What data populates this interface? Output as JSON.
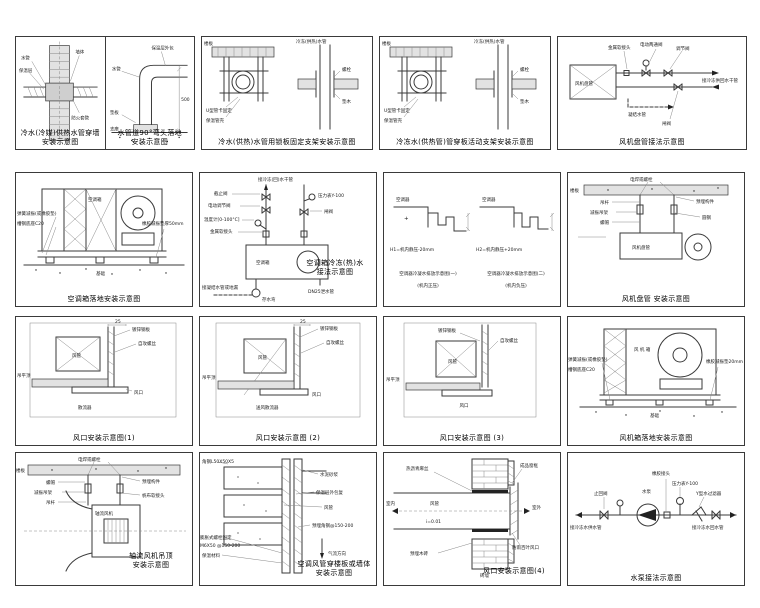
{
  "page": {
    "background": "#ffffff"
  },
  "panels": {
    "r1p1": {
      "caption1": "冷水(冷媒)供热水管穿墙",
      "caption2": "安装示意图",
      "labels": {
        "pipe": "水管",
        "insulation": "保温层",
        "wall": "墙体",
        "sleeve": "防火套管"
      }
    },
    "r1p2": {
      "caption1": "水管道90°弯头落地",
      "caption2": "安装示意图",
      "labels": {
        "insulation": "保温层外包",
        "pipe": "水管",
        "pad": "垫板",
        "support": "支座",
        "dim": "500"
      }
    },
    "r1p3": {
      "caption1": "冷水(供热)水管用锁板固定支架安装示意图",
      "labels": {
        "slab": "楼板",
        "clamp": "U型管卡固定",
        "shell": "保温管壳",
        "pipe": "冷冻(供热)水管",
        "bolt": "螺栓",
        "wood": "垫木"
      }
    },
    "r1p4": {
      "caption1": "冷冻水(供热管)管穿板活动支架安装示意图",
      "labels": {
        "slab": "楼板",
        "clamp": "U型管卡固定",
        "shell": "保温管壳",
        "pipe": "冷冻(供热)水管",
        "bolt": "螺栓",
        "wood": "垫木"
      }
    },
    "r1p5": {
      "caption1": "风机盘管接法示意图",
      "labels": {
        "joint": "金属软接头",
        "valve": "电动两通阀",
        "regulate": "调节阀",
        "unit": "风机盘管",
        "drain": "凝结水管",
        "gate": "闸阀",
        "main": "接冷冻供回水干管"
      }
    },
    "r2p1": {
      "caption1": "空调箱落地安装示意图",
      "labels": {
        "spring": "弹簧减振(或橡胶垫)",
        "channel": "槽钢底座C20",
        "rubber": "橡胶减振垫厚50mm",
        "foundation": "基础",
        "unit": "空调箱"
      }
    },
    "r2p2": {
      "caption1": "空调箱冷冻(热)水",
      "caption2": "接法示意图",
      "labels": {
        "main": "接冷冻(回)水干管",
        "stop": "截止阀",
        "motor": "电动调节阀",
        "thermo": "温度计[0-100°C]",
        "joint": "金属软接头",
        "gauge": "压力表Y-100",
        "gate": "闸阀",
        "unit": "空调箱",
        "drainpipe": "DN25泄水管",
        "trap": "存水弯",
        "todrain": "接凝结水管或地漏"
      }
    },
    "r2p3": {
      "cap1a": "空调器冷凝水排放示意图(一)",
      "cap1b": "(机内正压)",
      "cap2a": "空调器冷凝水排放示意图(二)",
      "cap2b": "(机内负压)",
      "labels": {
        "unit1": "空调器",
        "plus": "+",
        "h1": "H1=机内静压-20mm",
        "unit2": "空调器",
        "h2": "H2=机内静压+20mm"
      }
    },
    "r2p4": {
      "caption1": "风机盘管    安装示意图",
      "labels": {
        "weld": "电焊或螺栓",
        "slab": "楼板",
        "rod": "吊杆",
        "hanger": "减振吊架",
        "nut": "螺帽",
        "embed": "预埋构件",
        "steel": "圆钢",
        "unit": "风机盘管"
      }
    },
    "r3p1": {
      "caption1": "风口安装示意图(1)",
      "labels": {
        "dim": "25",
        "sheet": "镀锌钢板",
        "duct": "风管",
        "ceiling": "吊平顶",
        "screw": "自攻螺丝",
        "outlet": "风口",
        "diffuser": "散流器"
      }
    },
    "r3p2": {
      "caption1": "风口安装示意图 (2)",
      "labels": {
        "dim": "25",
        "sheet": "镀锌钢板",
        "screw": "自攻螺丝",
        "duct": "风管",
        "ceiling": "吊平顶",
        "outlet": "风口",
        "diffuser": "送风散流器"
      }
    },
    "r3p3": {
      "caption1": "风口安装示意图 (3)",
      "labels": {
        "sheet": "镀锌钢板",
        "duct": "风管",
        "screw": "自攻螺丝",
        "ceiling": "吊平顶",
        "outlet": "风口"
      }
    },
    "r3p4": {
      "caption1": "风机箱落地安装示意图",
      "labels": {
        "spring": "弹簧减振(或橡胶垫)",
        "channel": "槽钢底座C20",
        "rubber": "橡胶减振垫20mm",
        "foundation": "基础",
        "unit": "风 机 箱"
      }
    },
    "r4p1": {
      "caption1": "轴流风机吊顶",
      "caption2": "安装示意图",
      "labels": {
        "weld": "电焊或螺栓",
        "slab": "楼板",
        "nut": "螺帽",
        "hanger": "减振吊架",
        "rod": "吊杆",
        "embed": "预埋构件",
        "canvas": "帆布软接头",
        "unit": "轴流风机"
      }
    },
    "r4p2": {
      "caption1": "空调风管穿楼板或墙体",
      "caption2": "安装示意图",
      "labels": {
        "angle": "角钢L50X50X5",
        "mortar": "水泥砂浆",
        "wrap": "保温层外包复",
        "duct": "风管",
        "embed": "预埋角钢@150-200",
        "bolt": "膨胀式螺栓固定",
        "bolt2": "M6X50 @150-200",
        "material": "保温材料",
        "airflow": "气流方向"
      }
    },
    "r4p3": {
      "caption1": "风口安装示意图(4)",
      "labels": {
        "tar": "热沥青麻丝",
        "duct": "风管",
        "slope": "i=0.01",
        "indoor": "室内",
        "outdoor": "室外",
        "frame": "成品窗框",
        "louver": "防雨百叶风口",
        "wood": "预埋木砖",
        "wall": "砖墙"
      }
    },
    "r4p4": {
      "caption1": "水泵接法示意图",
      "labels": {
        "check": "止回阀",
        "joint": "橡胶接头",
        "gauge": "压力表Y-100",
        "filter": "Y型水过滤器",
        "pump": "水泵",
        "left": "接冷冻水供水管",
        "right": "接冷冻水回水管"
      }
    }
  }
}
